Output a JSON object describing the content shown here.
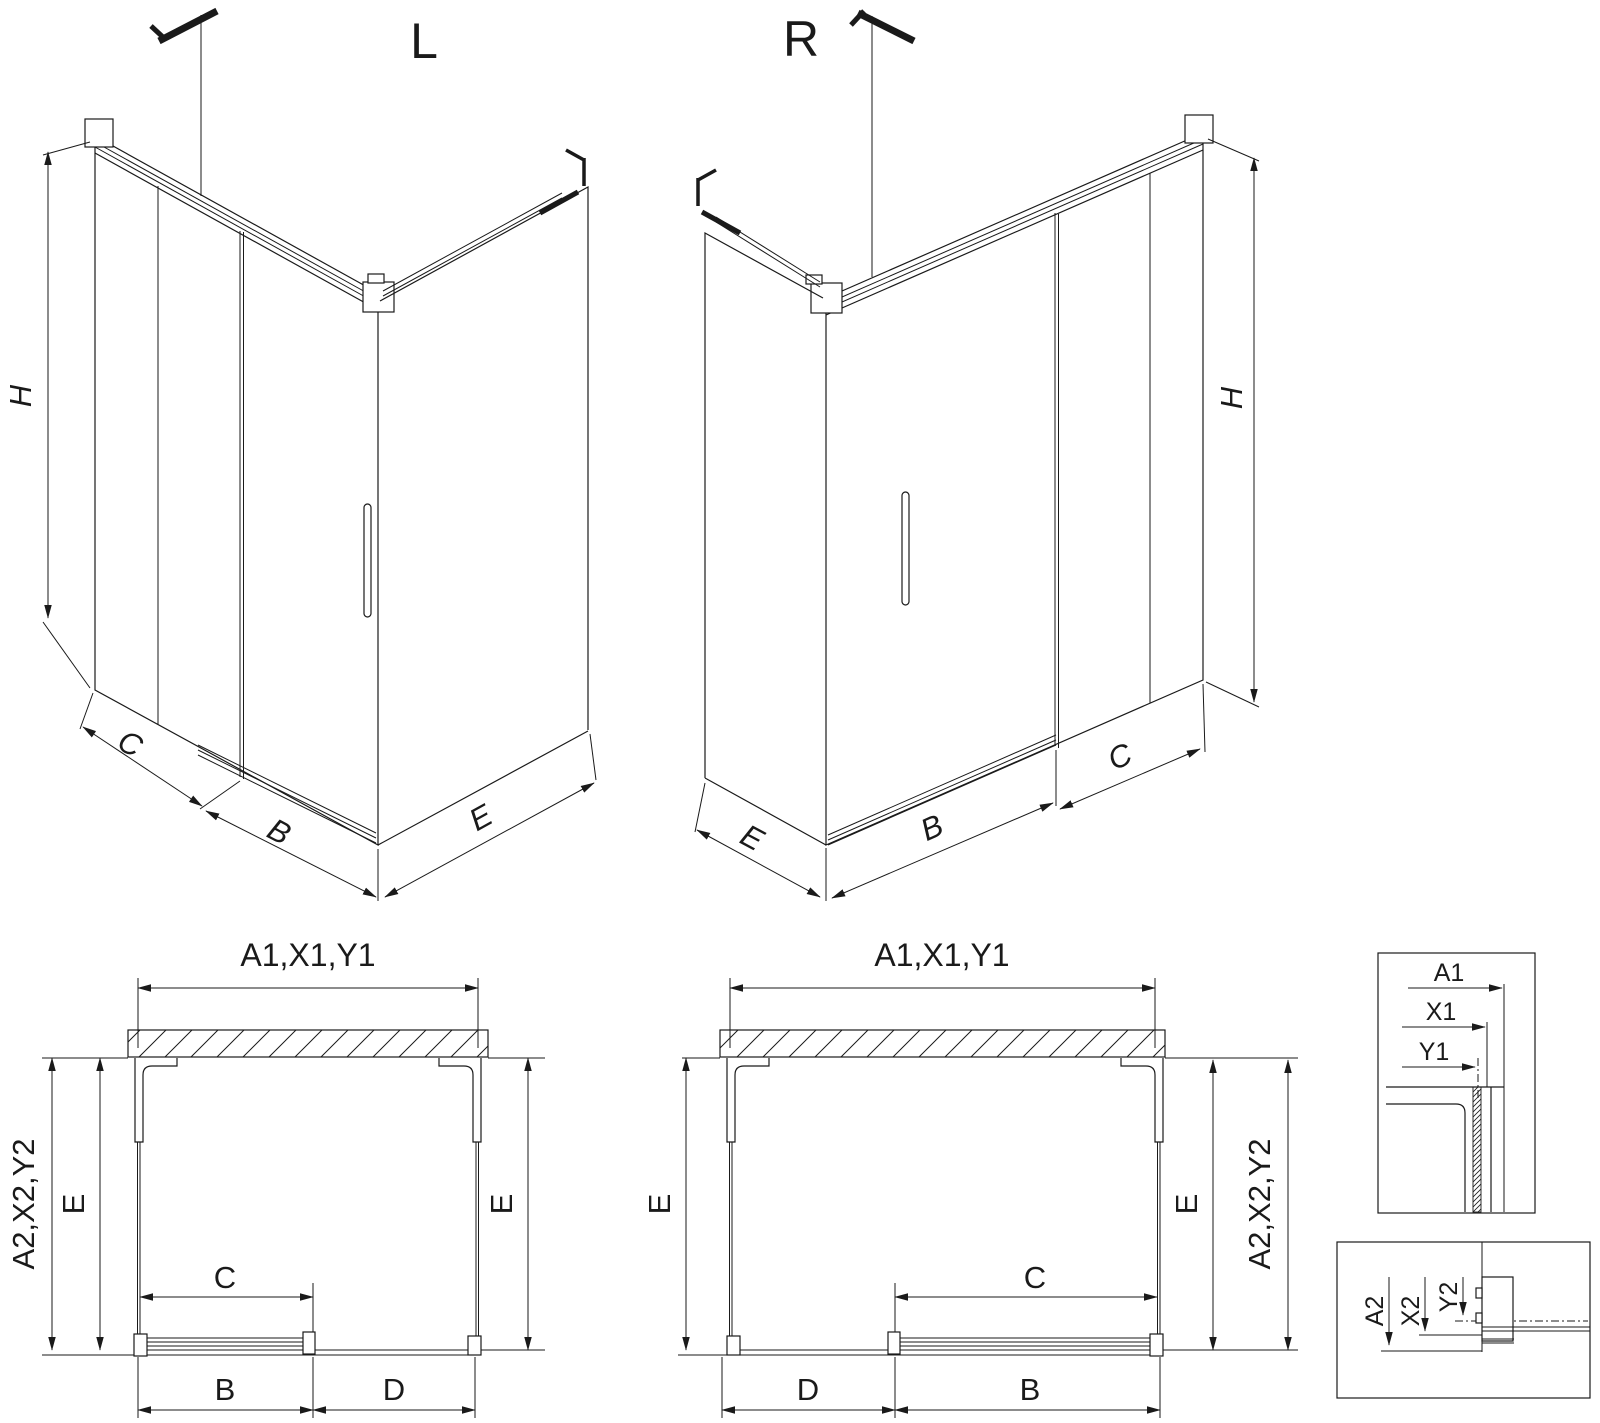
{
  "colors": {
    "line": "#1a1a1a",
    "background": "#ffffff"
  },
  "iso_left": {
    "title": "L",
    "dim_height": "H",
    "dim_panel": "C",
    "dim_door": "B",
    "dim_side": "E"
  },
  "iso_right": {
    "title": "R",
    "dim_height": "H",
    "dim_panel": "C",
    "dim_door": "B",
    "dim_side": "E"
  },
  "plan_left": {
    "dim_top": "A1,X1,Y1",
    "dim_side_outer": "A2,X2,Y2",
    "dim_depth_left": "E",
    "dim_depth_right": "E",
    "dim_opening": "C",
    "dim_bottom_left": "B",
    "dim_bottom_right": "D"
  },
  "plan_right": {
    "dim_top": "A1,X1,Y1",
    "dim_side_outer": "A2,X2,Y2",
    "dim_depth_left": "E",
    "dim_depth_right": "E",
    "dim_opening": "C",
    "dim_bottom_left": "D",
    "dim_bottom_right": "B"
  },
  "detail_top": {
    "dim_outer": "A1",
    "dim_mid": "X1",
    "dim_inner": "Y1"
  },
  "detail_bottom": {
    "dim_outer": "A2",
    "dim_mid": "X2",
    "dim_inner": "Y2"
  }
}
